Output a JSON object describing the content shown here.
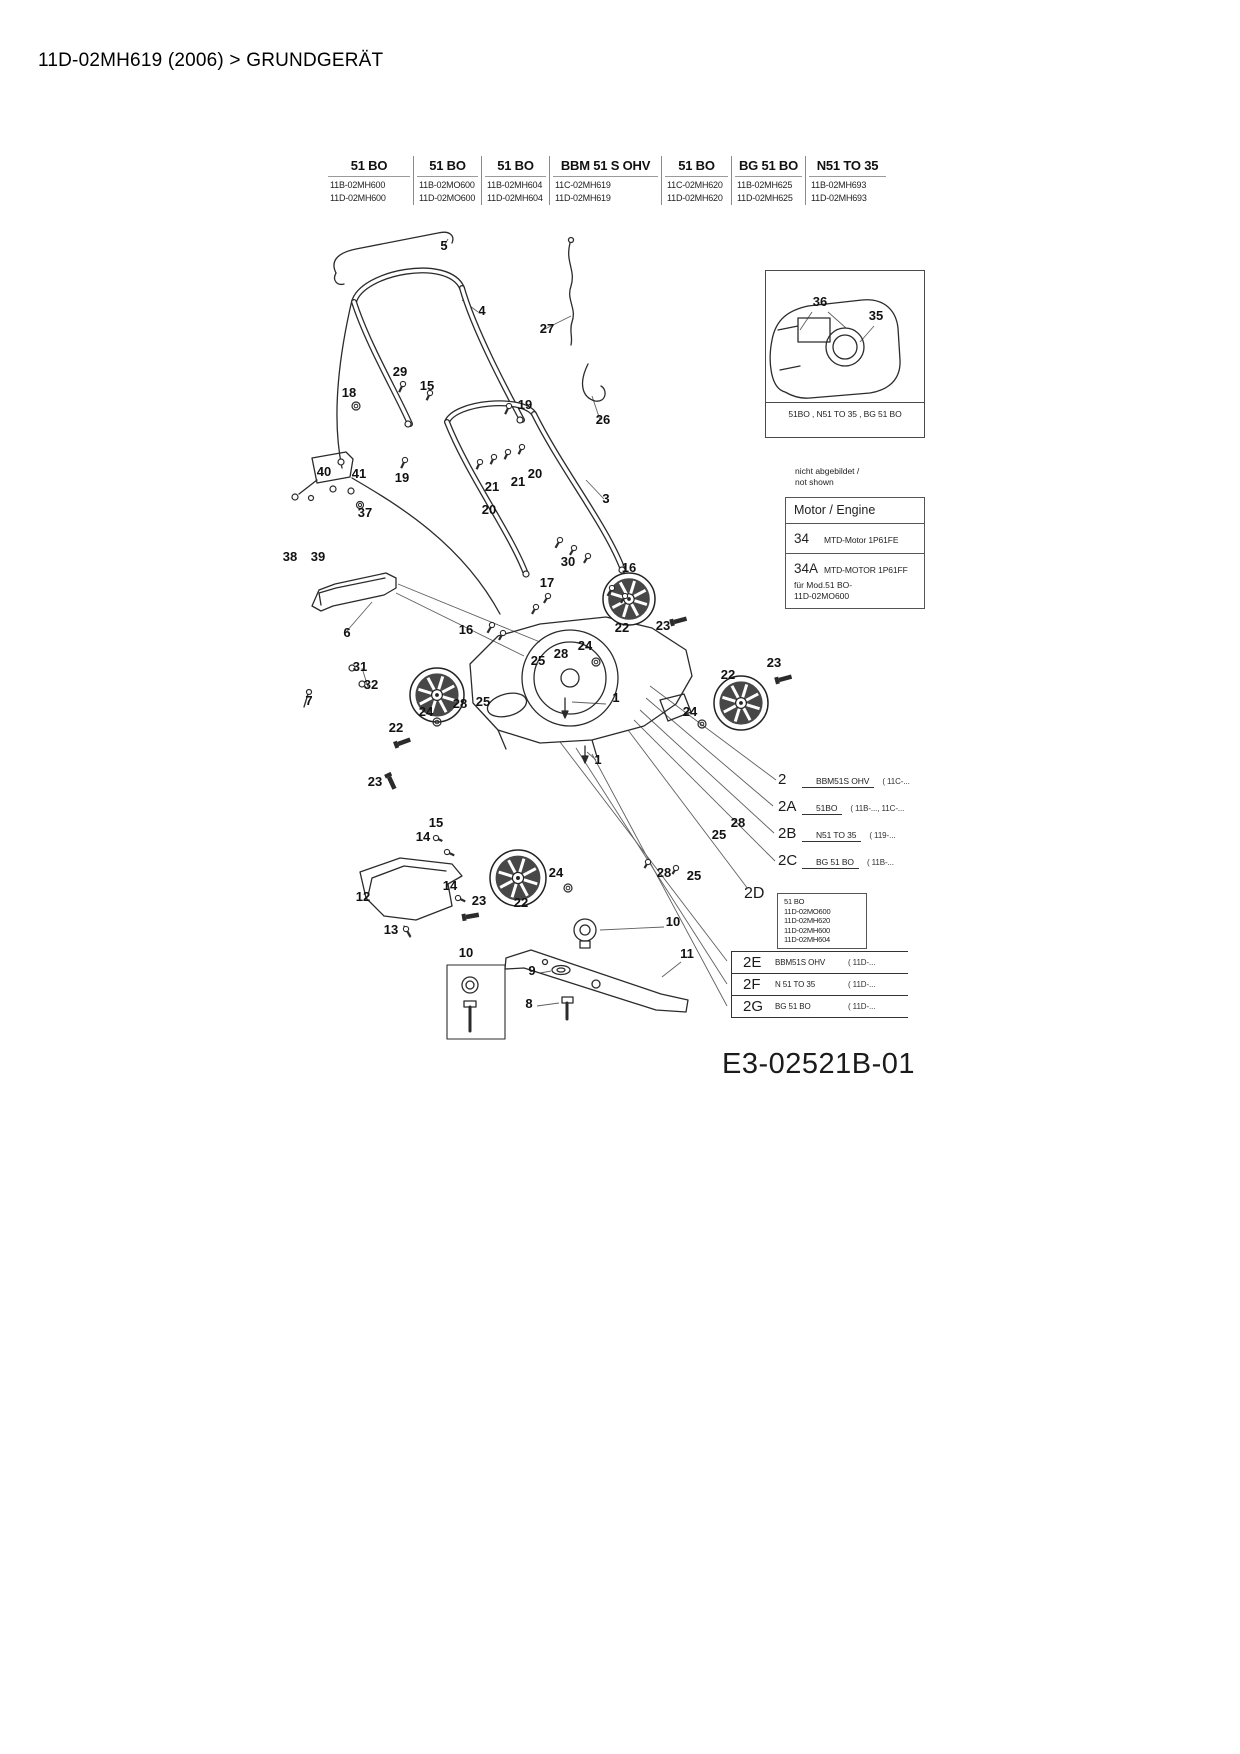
{
  "page": {
    "title": "11D-02MH619 (2006)  >  GRUNDGERÄT",
    "drawing_number": "E3-02521B-01"
  },
  "model_table": {
    "columns": [
      {
        "name": "51 BO",
        "models": [
          "11B-02MH600",
          "11D-02MH600"
        ]
      },
      {
        "name": "51 BO",
        "models": [
          "11B-02MO600",
          "11D-02MO600"
        ]
      },
      {
        "name": "51 BO",
        "models": [
          "11B-02MH604",
          "11D-02MH604"
        ]
      },
      {
        "name": "BBM 51 S OHV",
        "models": [
          "11C-02MH619",
          "11D-02MH619"
        ]
      },
      {
        "name": "51 BO",
        "models": [
          "11C-02MH620",
          "11D-02MH620"
        ]
      },
      {
        "name": "BG 51 BO",
        "models": [
          "11B-02MH625",
          "11D-02MH625"
        ]
      },
      {
        "name": "N51 TO 35",
        "models": [
          "11B-02MH693",
          "11D-02MH693"
        ]
      }
    ]
  },
  "engine_box": {
    "caption": "51BO , N51 TO 35 , BG 51 BO",
    "labels": [
      "36",
      "35"
    ]
  },
  "not_shown_note": {
    "line1": "nicht abgebildet /",
    "line2": "not shown"
  },
  "engine_table": {
    "header": "Motor / Engine",
    "rows": [
      {
        "ref": "34",
        "name": "MTD-Motor 1P61FE",
        "note1": "",
        "note2": ""
      },
      {
        "ref": "34A",
        "name": "MTD-MOTOR 1P61FF",
        "note1": "für Mod.51 BO-",
        "note2": "11D-02MO600"
      }
    ]
  },
  "variant_legend": {
    "underline_rows": [
      {
        "ref": "2",
        "name": "BBM51S OHV",
        "models": "( 11C-..."
      },
      {
        "ref": "2A",
        "name": "51BO",
        "models": "( 11B-..., 11C-..."
      },
      {
        "ref": "2B",
        "name": "N51 TO 35",
        "models": "( 119-..."
      },
      {
        "ref": "2C",
        "name": "BG 51 BO",
        "models": "( 11B-..."
      }
    ],
    "box_2d": {
      "ref": "2D",
      "lines": [
        "51 BO",
        "11D-02MO600",
        "11D-02MH620",
        "11D-02MH600",
        "11D-02MH604"
      ]
    },
    "table_rows": [
      {
        "ref": "2E",
        "name": "BBM51S OHV",
        "models": "( 11D-..."
      },
      {
        "ref": "2F",
        "name": "N 51 TO 35",
        "models": "( 11D-..."
      },
      {
        "ref": "2G",
        "name": "BG 51 BO",
        "models": "( 11D-..."
      }
    ]
  },
  "part_labels": [
    {
      "t": "5",
      "x": 444,
      "y": 250
    },
    {
      "t": "4",
      "x": 482,
      "y": 315
    },
    {
      "t": "27",
      "x": 547,
      "y": 333
    },
    {
      "t": "29",
      "x": 400,
      "y": 376
    },
    {
      "t": "15",
      "x": 427,
      "y": 390
    },
    {
      "t": "18",
      "x": 349,
      "y": 397
    },
    {
      "t": "19",
      "x": 525,
      "y": 409
    },
    {
      "t": "26",
      "x": 603,
      "y": 424
    },
    {
      "t": "19",
      "x": 402,
      "y": 482
    },
    {
      "t": "40",
      "x": 324,
      "y": 476
    },
    {
      "t": "41",
      "x": 359,
      "y": 478
    },
    {
      "t": "20",
      "x": 535,
      "y": 478
    },
    {
      "t": "21",
      "x": 518,
      "y": 486
    },
    {
      "t": "21",
      "x": 492,
      "y": 491
    },
    {
      "t": "20",
      "x": 489,
      "y": 514
    },
    {
      "t": "3",
      "x": 606,
      "y": 503
    },
    {
      "t": "37",
      "x": 365,
      "y": 517
    },
    {
      "t": "38",
      "x": 290,
      "y": 561
    },
    {
      "t": "39",
      "x": 318,
      "y": 561
    },
    {
      "t": "30",
      "x": 568,
      "y": 566
    },
    {
      "t": "17",
      "x": 547,
      "y": 587
    },
    {
      "t": "16",
      "x": 629,
      "y": 572
    },
    {
      "t": "16",
      "x": 466,
      "y": 634
    },
    {
      "t": "6",
      "x": 347,
      "y": 637
    },
    {
      "t": "31",
      "x": 360,
      "y": 671
    },
    {
      "t": "32",
      "x": 371,
      "y": 689
    },
    {
      "t": "7",
      "x": 309,
      "y": 705
    },
    {
      "t": "25",
      "x": 538,
      "y": 665
    },
    {
      "t": "28",
      "x": 561,
      "y": 658
    },
    {
      "t": "24",
      "x": 585,
      "y": 650
    },
    {
      "t": "22",
      "x": 622,
      "y": 632
    },
    {
      "t": "23",
      "x": 663,
      "y": 630
    },
    {
      "t": "22",
      "x": 728,
      "y": 679
    },
    {
      "t": "23",
      "x": 774,
      "y": 667
    },
    {
      "t": "24",
      "x": 690,
      "y": 716
    },
    {
      "t": "22",
      "x": 396,
      "y": 732
    },
    {
      "t": "24",
      "x": 426,
      "y": 716
    },
    {
      "t": "28",
      "x": 460,
      "y": 708
    },
    {
      "t": "25",
      "x": 483,
      "y": 706
    },
    {
      "t": "23",
      "x": 375,
      "y": 786
    },
    {
      "t": "1",
      "x": 616,
      "y": 702
    },
    {
      "t": "1",
      "x": 598,
      "y": 764
    },
    {
      "t": "28",
      "x": 738,
      "y": 827
    },
    {
      "t": "25",
      "x": 719,
      "y": 839
    },
    {
      "t": "28",
      "x": 664,
      "y": 877
    },
    {
      "t": "25",
      "x": 694,
      "y": 880
    },
    {
      "t": "15",
      "x": 436,
      "y": 827
    },
    {
      "t": "14",
      "x": 423,
      "y": 841
    },
    {
      "t": "14",
      "x": 450,
      "y": 890
    },
    {
      "t": "23",
      "x": 479,
      "y": 905
    },
    {
      "t": "22",
      "x": 521,
      "y": 907
    },
    {
      "t": "24",
      "x": 556,
      "y": 877
    },
    {
      "t": "12",
      "x": 363,
      "y": 901
    },
    {
      "t": "13",
      "x": 391,
      "y": 934
    },
    {
      "t": "10",
      "x": 673,
      "y": 926
    },
    {
      "t": "11",
      "x": 687,
      "y": 958
    },
    {
      "t": "10",
      "x": 466,
      "y": 957
    },
    {
      "t": "9",
      "x": 532,
      "y": 975
    },
    {
      "t": "8",
      "x": 529,
      "y": 1008
    },
    {
      "t": "36",
      "x": 820,
      "y": 306
    },
    {
      "t": "35",
      "x": 876,
      "y": 320
    }
  ]
}
